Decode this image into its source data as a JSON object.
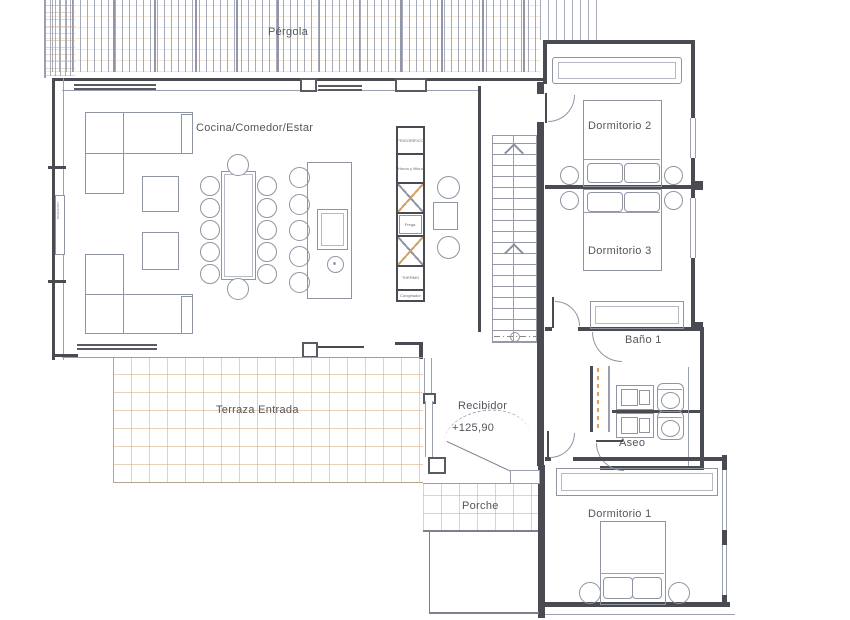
{
  "document": {
    "type": "architectural-floor-plan"
  },
  "labels": {
    "pergola": "Pérgola",
    "living": "Cocina/Comedor/Estar",
    "dormitorio2": "Dormitorio 2",
    "dormitorio3": "Dormitorio 3",
    "bano1": "Baño 1",
    "aseo": "Aseo",
    "dormitorio1": "Dormitorio 1",
    "recibidor": "Recibidor",
    "recibidor_level": "+125,90",
    "terraza": "Terraza Entrada",
    "porche": "Porche"
  },
  "kitchen_column": {
    "cells": [
      {
        "label": "FRIGORÍFICO"
      },
      {
        "label": "Horno y Micro"
      },
      {
        "label": ""
      },
      {
        "label": "Frega."
      },
      {
        "label": ""
      },
      {
        "label": "THERMO"
      },
      {
        "label": "Congelador"
      }
    ]
  },
  "window_tag": "corredera",
  "stairs": {
    "direction": "up"
  },
  "colors": {
    "wall": "#4a4a52",
    "drawing_line": "#9095a3",
    "grid_tan": "#d2a878",
    "accent_dash": "#e0a050",
    "text": "#54555c"
  }
}
